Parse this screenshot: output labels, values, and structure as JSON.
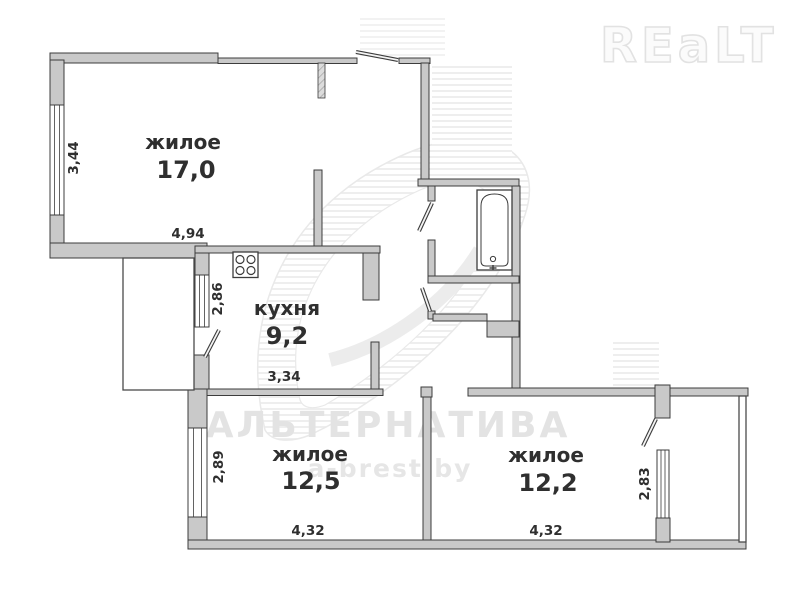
{
  "watermarks": {
    "realt_logo": "REaLT",
    "agency": "АЛЬТЕРНАТИВА",
    "website": "а-brest.by"
  },
  "rooms": [
    {
      "label": "жилое",
      "area": "17,0"
    },
    {
      "label": "кухня",
      "area": "9,2"
    },
    {
      "label": "жилое",
      "area": "12,5"
    },
    {
      "label": "жилое",
      "area": "12,2"
    }
  ],
  "dimensions": {
    "living1_width": "4,94",
    "living1_height": "3,44",
    "kitchen_width": "3,34",
    "kitchen_height": "2,86",
    "living2_width": "4,32",
    "living2_height": "2,89",
    "living3_width": "4,32",
    "living3_height": "2,83"
  },
  "colors": {
    "wall_fill": "#c9c9c9",
    "wall_outline": "#3c3c3c",
    "label_text": "#2f2f2f",
    "watermark": "#e3e3e3"
  }
}
